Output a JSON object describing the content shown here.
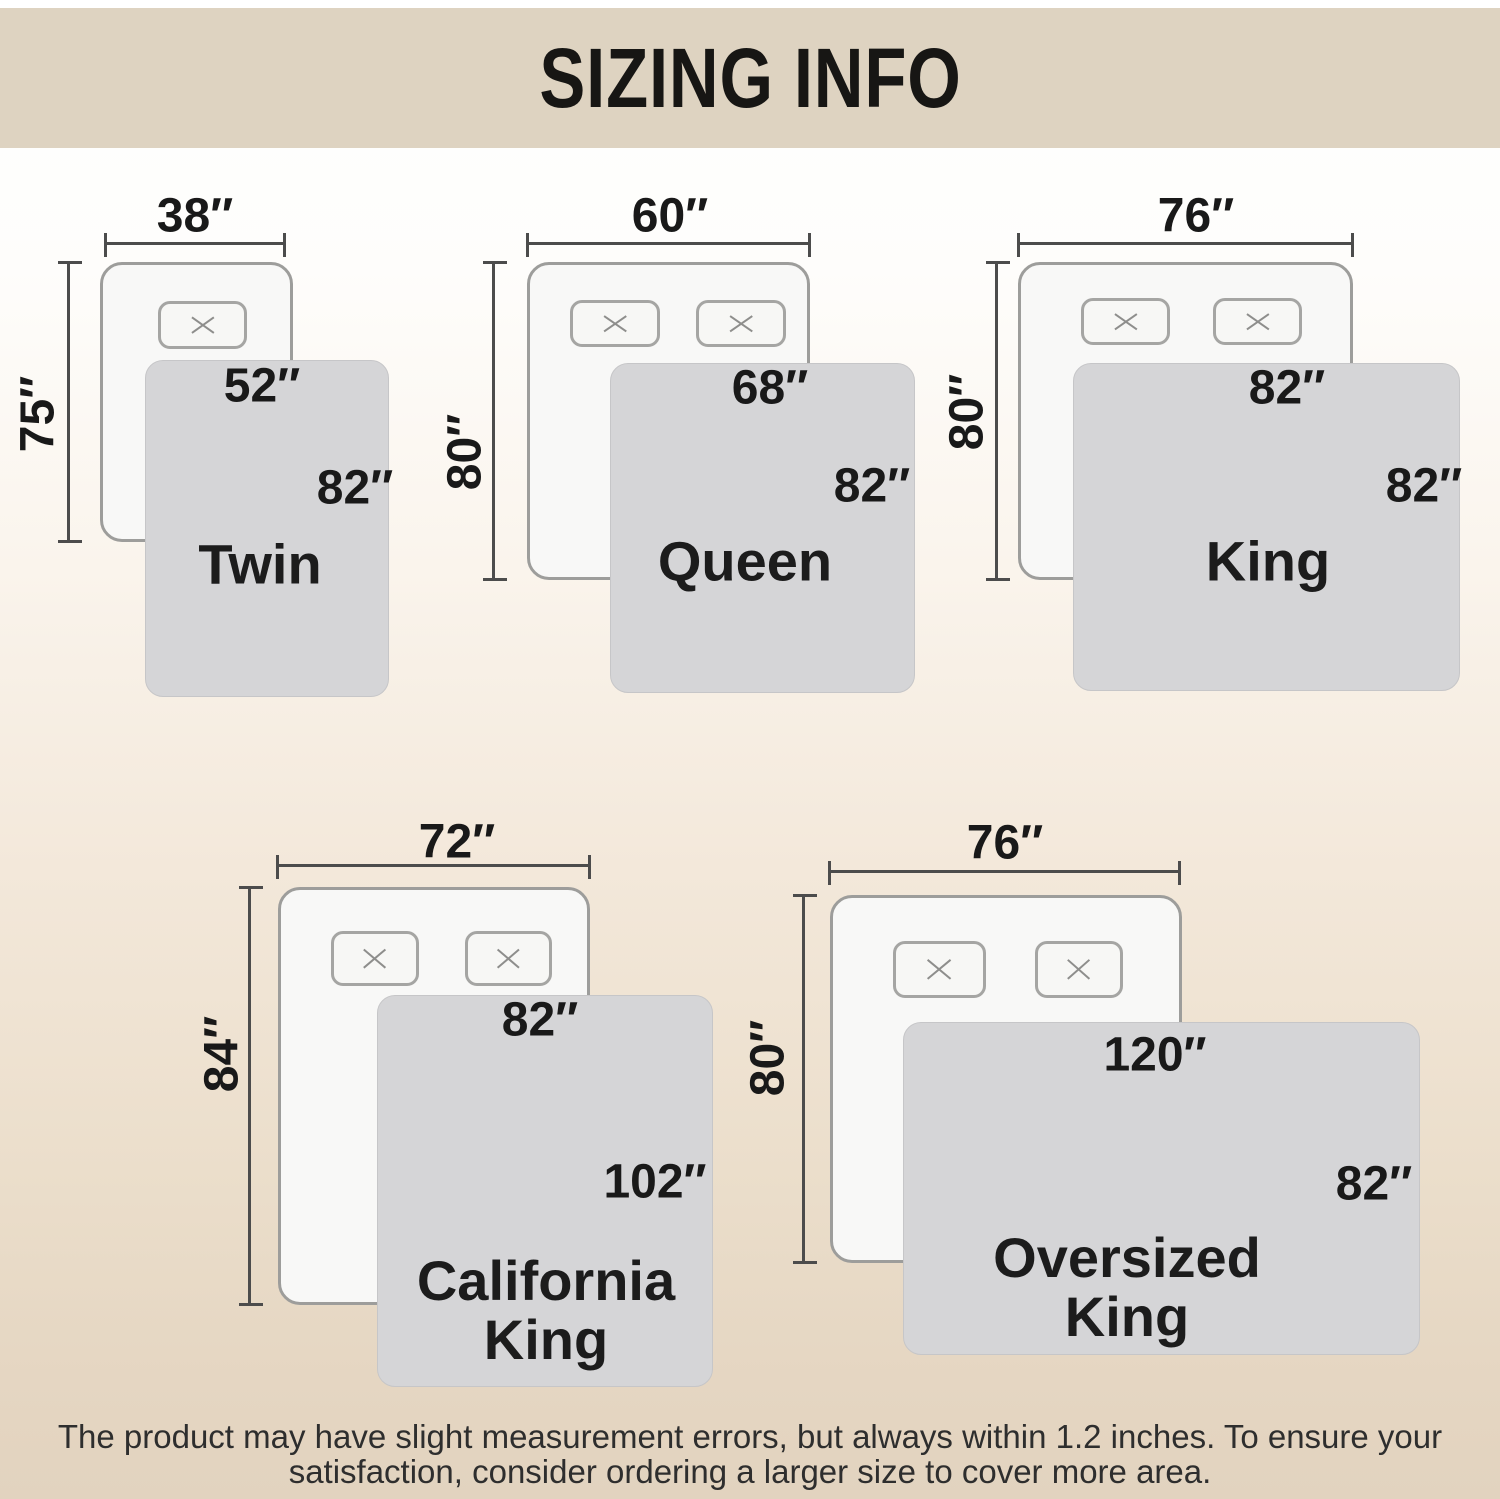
{
  "header": {
    "title": "SIZING INFO"
  },
  "sizes": [
    {
      "name": "Twin",
      "bed_width": "38″",
      "bed_length": "75″",
      "blanket_width": "52″",
      "blanket_length": "82″"
    },
    {
      "name": "Queen",
      "bed_width": "60″",
      "bed_length": "80″",
      "blanket_width": "68″",
      "blanket_length": "82″"
    },
    {
      "name": "King",
      "bed_width": "76″",
      "bed_length": "80″",
      "blanket_width": "82″",
      "blanket_length": "82″"
    },
    {
      "name": "California\nKing",
      "bed_width": "72″",
      "bed_length": "84″",
      "blanket_width": "82″",
      "blanket_length": "102″"
    },
    {
      "name": "Oversized\nKing",
      "bed_width": "76″",
      "bed_length": "80″",
      "blanket_width": "120″",
      "blanket_length": "82″"
    }
  ],
  "footer": {
    "line1": "The product may have slight measurement errors, but always within 1.2 inches. To ensure your",
    "line2": "satisfaction, consider ordering a larger size to cover more area."
  },
  "colors": {
    "header_band": "#ded3c1",
    "background_bottom": "#e2d3bf",
    "bed_fill": "#f8f8f7",
    "bed_border": "#9d9d9b",
    "blanket_fill": "#d5d5d7",
    "dimension_line": "#4c4c4c",
    "text": "#1b1b1b"
  }
}
